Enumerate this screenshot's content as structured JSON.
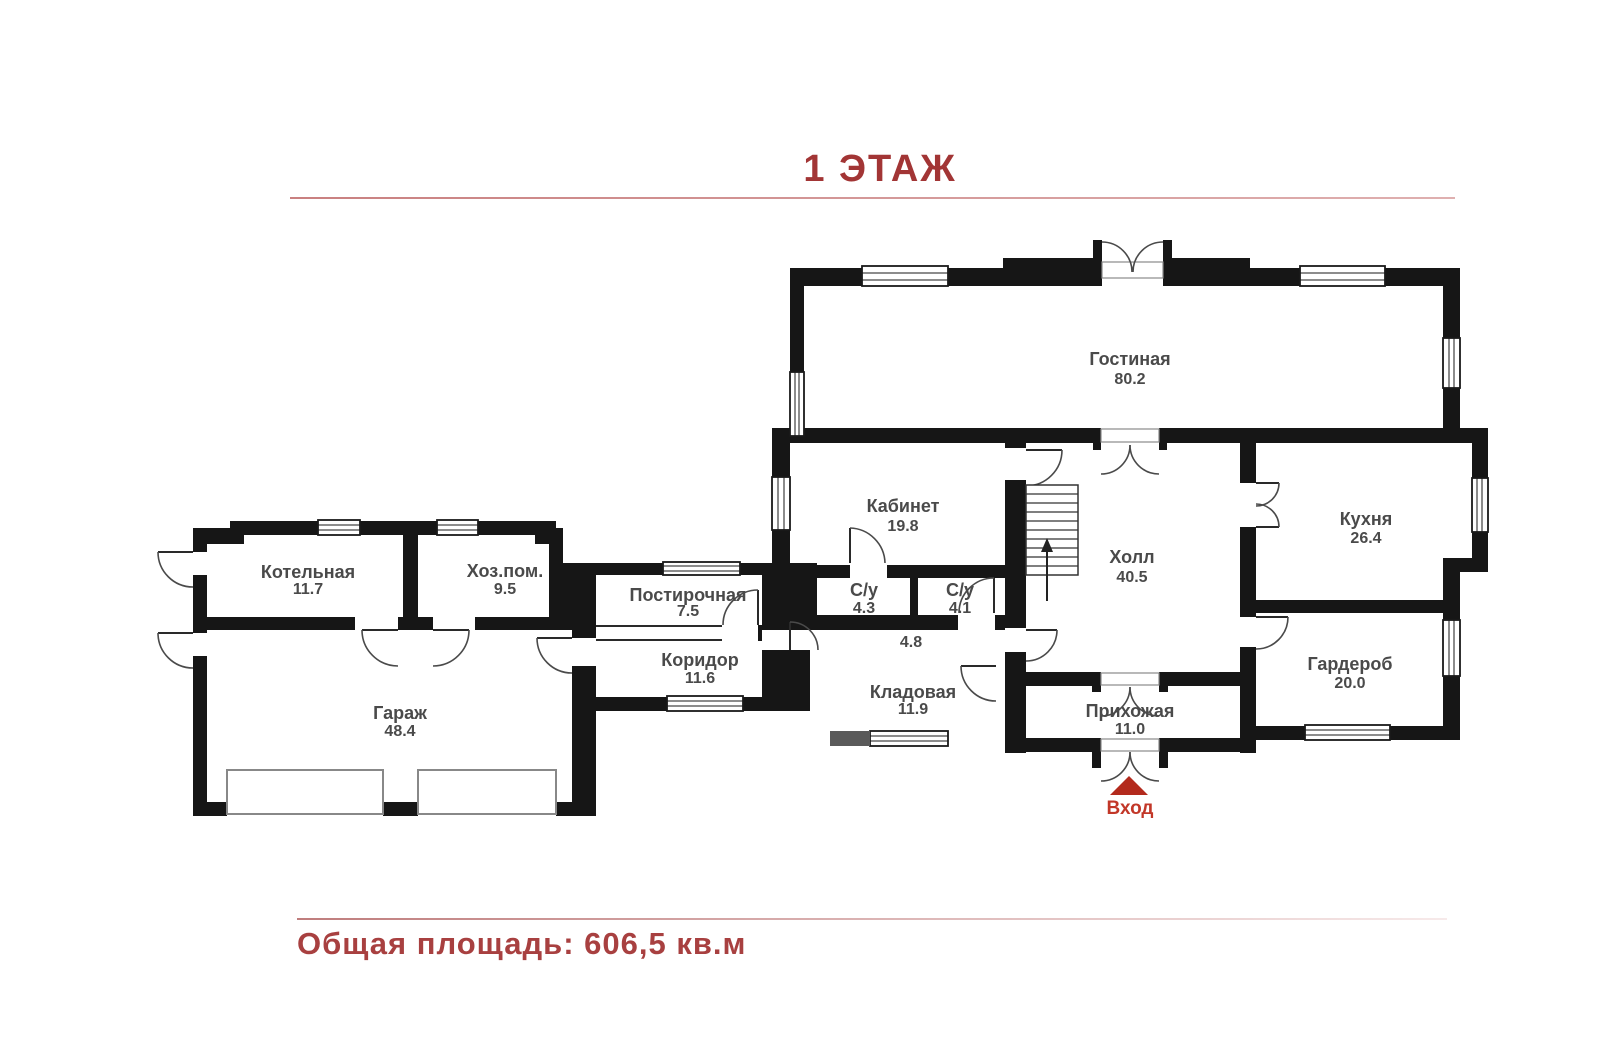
{
  "title": "1 ЭТАЖ",
  "footer": {
    "total_area": "Общая площадь: 606,5 кв.м"
  },
  "entrance": {
    "label": "Вход"
  },
  "colors": {
    "accent_red": "#a23535",
    "wall_black": "#161616",
    "entrance_marker_red": "#b32a1d",
    "room_label_gray": "#4a4a4a"
  },
  "rooms": [
    {
      "name": "Гостиная",
      "area": "80.2"
    },
    {
      "name": "Кабинет",
      "area": "19.8"
    },
    {
      "name": "Холл",
      "area": "40.5"
    },
    {
      "name": "Кухня",
      "area": "26.4"
    },
    {
      "name": "Гардероб",
      "area": "20.0"
    },
    {
      "name": "Прихожая",
      "area": "11.0"
    },
    {
      "name": "Кладовая",
      "area": "11.9"
    },
    {
      "name": "Котельная",
      "area": "11.7"
    },
    {
      "name": "Хоз.пом.",
      "area": "9.5"
    },
    {
      "name": "Постирочная",
      "area": "7.5"
    },
    {
      "name": "Коридор",
      "area": "11.6"
    },
    {
      "name": "С/у",
      "area": "4.3"
    },
    {
      "name": "С/у",
      "area": "4.1"
    },
    {
      "name": "Гараж",
      "area": "48.4"
    },
    {
      "name": "",
      "area": "4.8"
    }
  ]
}
